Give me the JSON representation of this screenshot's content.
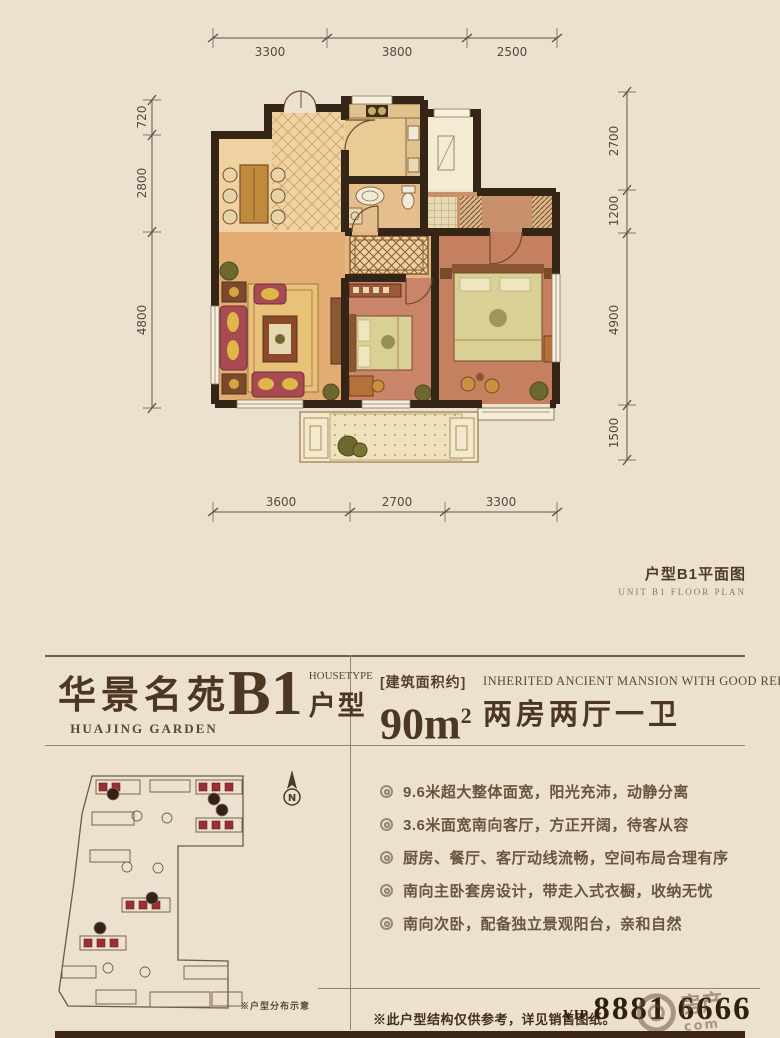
{
  "plan": {
    "caption_cn": "户型B1平面图",
    "caption_en": "UNIT B1 FLOOR PLAN",
    "dims": {
      "top": [
        "3300",
        "3800",
        "2500"
      ],
      "left": [
        "720",
        "2800",
        "4800"
      ],
      "right": [
        "2700",
        "1200",
        "4900",
        "1500"
      ],
      "bottom": [
        "3600",
        "2700",
        "3300"
      ]
    }
  },
  "header": {
    "brand_cn": "华景名苑",
    "brand_en": "HUAJING GARDEN",
    "unit_code": "B1",
    "unit_type_en": "HOUSETYPE",
    "unit_type_cn": "户型",
    "area_label": "[建筑面积约]",
    "area_value": "90m",
    "area_sup": "2",
    "slogan_en": "INHERITED ANCIENT MANSION WITH GOOD REPUTATION",
    "layout_cn": "两房两厅一卫"
  },
  "features": [
    "9.6米超大整体面宽，阳光充沛，动静分离",
    "3.6米面宽南向客厅，方正开阔，待客从容",
    "厨房、餐厅、客厅动线流畅，空间布局合理有序",
    "南向主卧套房设计，带走入式衣橱，收纳无忧",
    "南向次卧，配备独立景观阳台，亲和自然"
  ],
  "siteplan": {
    "north": "N",
    "caption": "※户型分布示意"
  },
  "footer": {
    "note": "※此户型结构仅供参考，详见销售图纸。",
    "vip_label": "VIP.",
    "vip_number": "8881 6666",
    "watermark_cn": "房产",
    "watermark_en": "com"
  },
  "colors": {
    "paper": "#ece1cf",
    "ink": "#4c3722",
    "wall": "#342516",
    "bedroom": "#c5805f",
    "living": "#e3ac73",
    "dining": "#eed2a2",
    "balcony": "#f3eace",
    "sofa_red": "#a84a52",
    "accent_red": "#9a2f33",
    "bottom_bar": "#3d2618"
  }
}
